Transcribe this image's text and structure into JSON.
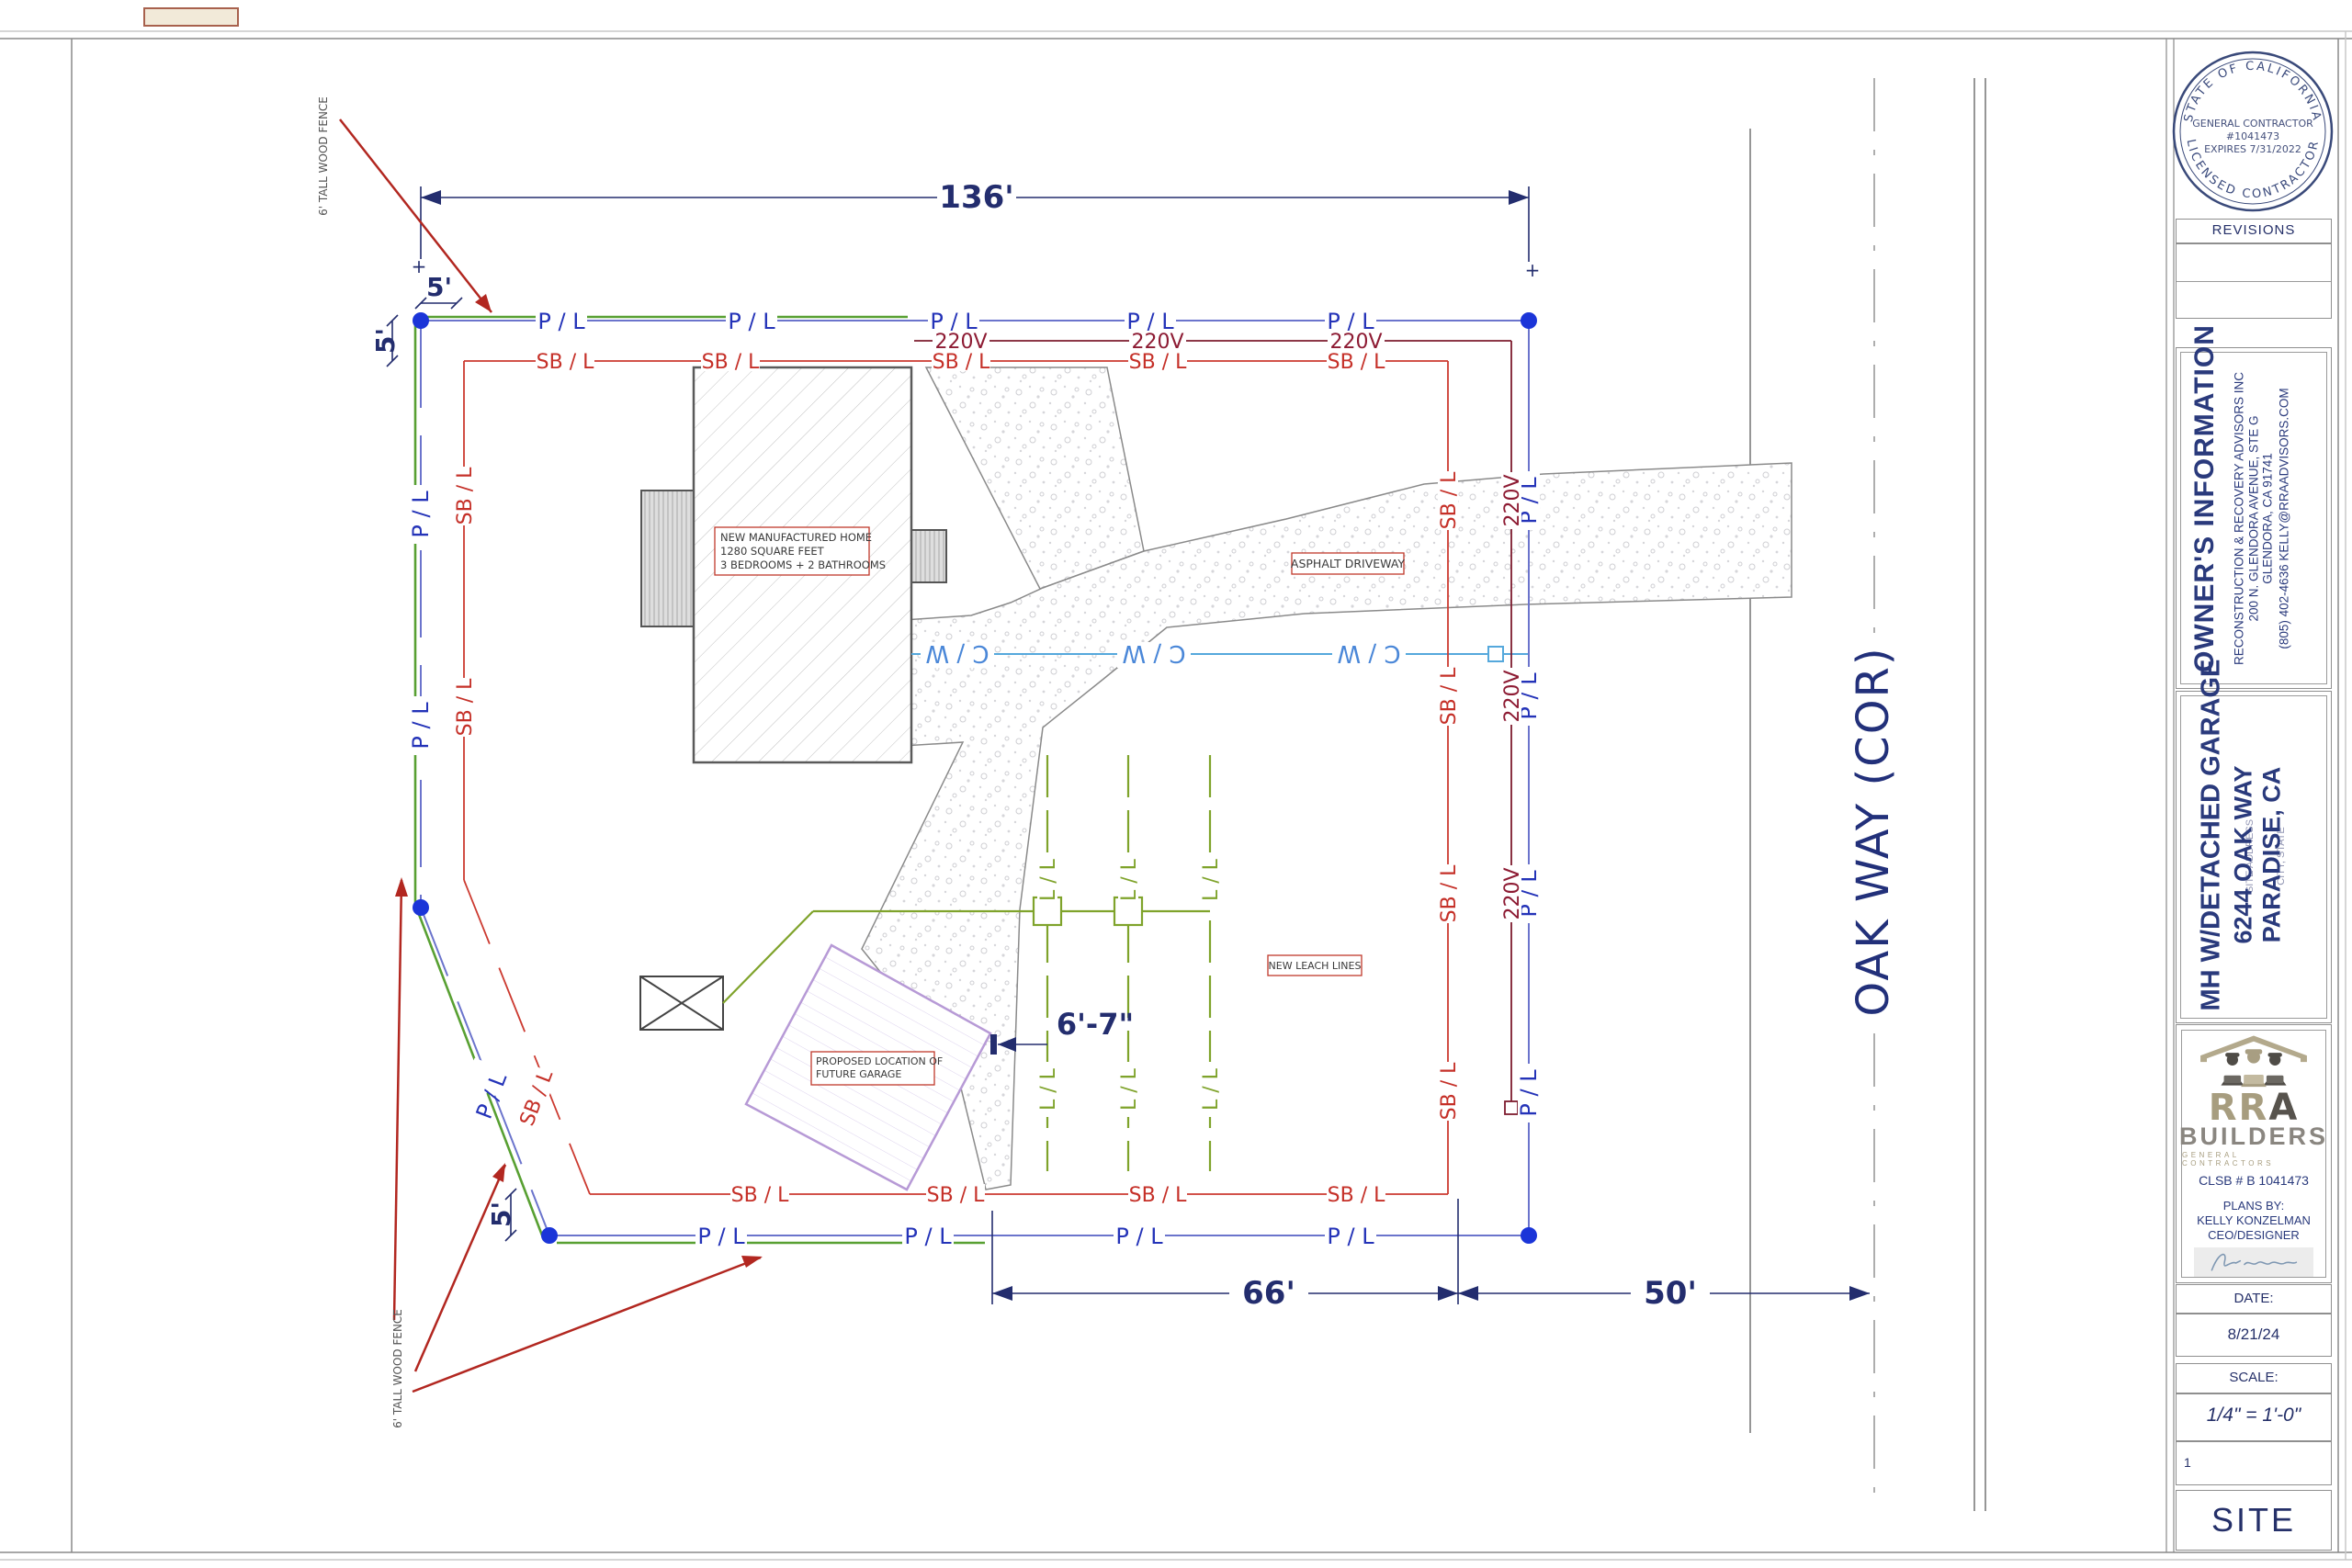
{
  "plan": {
    "labels": {
      "pl": "P / L",
      "sbl": "SB / L",
      "v220": "220V",
      "cw": "C / W",
      "ll": "L / L",
      "plus": "+"
    },
    "dims": {
      "lot_width": "136'",
      "frontage": "66'",
      "half_street": "50'",
      "setback5": "5'",
      "leach_offset": "6'-7\""
    },
    "street": "OAK WAY (COR)",
    "fence_note": "6' TALL WOOD FENCE",
    "house_note": [
      "NEW MANUFACTURED HOME",
      "1280 SQUARE FEET",
      "3 BEDROOMS + 2 BATHROOMS"
    ],
    "driveway_label": "ASPHALT DRIVEWAY",
    "leach_label": "NEW LEACH LINES",
    "garage_note": [
      "PROPOSED LOCATION OF",
      "FUTURE  GARAGE"
    ]
  },
  "titleblock": {
    "stamp": {
      "top": "STATE OF CALIFORNIA",
      "bottom": "LICENSED CONTRACTOR",
      "line1": "GENERAL CONTRACTOR",
      "line2": "#1041473",
      "line3": "EXPIRES 7/31/2022"
    },
    "revisions": "REVISIONS",
    "owner": {
      "title": "OWNER'S INFORMATION",
      "line1": "RECONSTRUCTION & RECOVERY ADVISORS INC",
      "line2": "200 N. GLENDORA AVENUE, STE G",
      "line3": "GLENDORA, CA 91741",
      "line4": "(805) 402-4636  KELLY@RRAADVISORS.COM"
    },
    "project": {
      "line1": "MH W/DETACHED GARAGE",
      "line2": "6244 OAK WAY",
      "line3": "PARADISE, CA",
      "ph1": "SITE ADDRESS",
      "ph2": "CITY, STATE"
    },
    "builder": {
      "rra1": "RR",
      "rra2": "A",
      "builders": "BUILDERS",
      "gc": "GENERAL CONTRACTORS",
      "clsb": "CLSB # B 1041473",
      "plans_by": "PLANS BY:",
      "name": "KELLY KONZELMAN",
      "role": "CEO/DESIGNER"
    },
    "date_label": "DATE:",
    "date": "8/21/24",
    "scale_label": "SCALE:",
    "scale": "1/4\" = 1'-0\"",
    "sheet_num": "1",
    "sheet_name": "SITE"
  }
}
